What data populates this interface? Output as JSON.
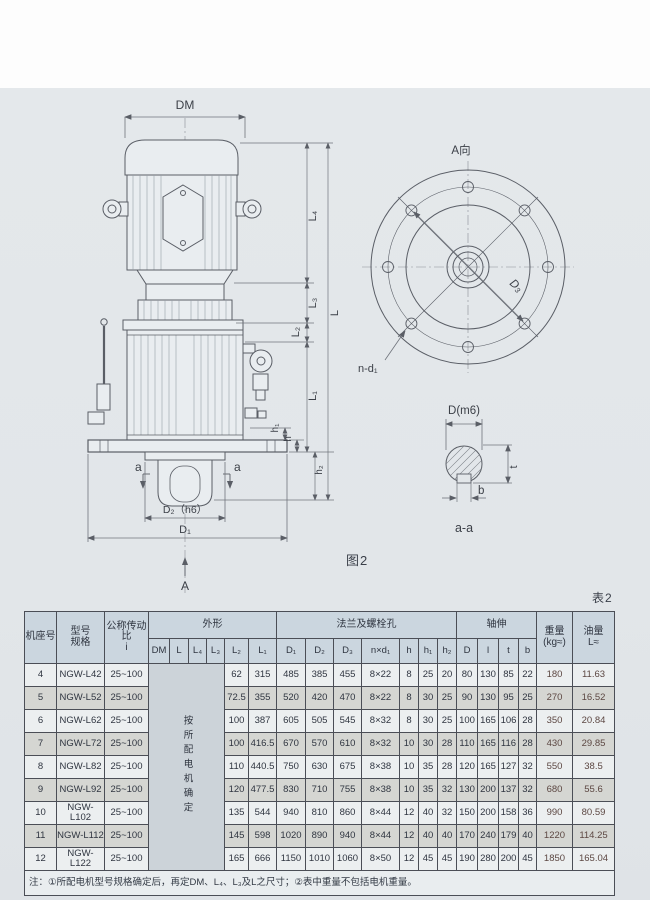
{
  "page": {
    "figure_caption": "图2",
    "table_caption": "表2"
  },
  "drawing": {
    "labels": {
      "dm": "DM",
      "l4": "L₄",
      "l3": "L₃",
      "l2": "L₂",
      "l1": "L₁",
      "l": "L",
      "h1": "h₁",
      "h": "h",
      "h2": "h₂",
      "d2h6": "D₂（h6）",
      "d1": "D₁",
      "a_bottom": "A",
      "a_left": "a",
      "a_right": "a",
      "flange_view": "A向",
      "d3": "D₃",
      "nd1": "n-d₁",
      "shaft_d": "D(m6)",
      "t": "t",
      "b": "b",
      "section": "a-a"
    }
  },
  "table": {
    "headers": {
      "frame": "机座号",
      "model": "型号\n规格",
      "ratio": "公称传动比\ni",
      "outline": "外形",
      "outline_cols": [
        "DM",
        "L",
        "L₄",
        "L₃",
        "L₂",
        "L₁"
      ],
      "flange": "法兰及螺栓孔",
      "flange_cols": [
        "D₁",
        "D₂",
        "D₃",
        "n×d₁",
        "h",
        "h₁",
        "h₂"
      ],
      "shaft": "轴伸",
      "shaft_cols": [
        "D",
        "l",
        "t",
        "b"
      ],
      "weight": "重量\n(kg≈)",
      "oil": "油量\nL≈"
    },
    "merged_note": "按所配电机确定",
    "rows": [
      {
        "frame": "4",
        "model": "NGW-L42",
        "ratio": "25~100",
        "l2": "62",
        "l1": "315",
        "d1": "485",
        "d2": "385",
        "d3": "455",
        "nd1": "8×22",
        "h": "8",
        "h1": "25",
        "h2": "20",
        "d": "80",
        "l": "130",
        "t": "85",
        "b": "22",
        "weight": "180",
        "oil": "11.63"
      },
      {
        "frame": "5",
        "model": "NGW-L52",
        "ratio": "25~100",
        "l2": "72.5",
        "l1": "355",
        "d1": "520",
        "d2": "420",
        "d3": "470",
        "nd1": "8×22",
        "h": "8",
        "h1": "30",
        "h2": "25",
        "d": "90",
        "l": "130",
        "t": "95",
        "b": "25",
        "weight": "270",
        "oil": "16.52"
      },
      {
        "frame": "6",
        "model": "NGW-L62",
        "ratio": "25~100",
        "l2": "100",
        "l1": "387",
        "d1": "605",
        "d2": "505",
        "d3": "545",
        "nd1": "8×32",
        "h": "8",
        "h1": "30",
        "h2": "25",
        "d": "100",
        "l": "165",
        "t": "106",
        "b": "28",
        "weight": "350",
        "oil": "20.84"
      },
      {
        "frame": "7",
        "model": "NGW-L72",
        "ratio": "25~100",
        "l2": "100",
        "l1": "416.5",
        "d1": "670",
        "d2": "570",
        "d3": "610",
        "nd1": "8×32",
        "h": "10",
        "h1": "30",
        "h2": "28",
        "d": "110",
        "l": "165",
        "t": "116",
        "b": "28",
        "weight": "430",
        "oil": "29.85"
      },
      {
        "frame": "8",
        "model": "NGW-L82",
        "ratio": "25~100",
        "l2": "110",
        "l1": "440.5",
        "d1": "750",
        "d2": "630",
        "d3": "675",
        "nd1": "8×38",
        "h": "10",
        "h1": "35",
        "h2": "28",
        "d": "120",
        "l": "165",
        "t": "127",
        "b": "32",
        "weight": "550",
        "oil": "38.5"
      },
      {
        "frame": "9",
        "model": "NGW-L92",
        "ratio": "25~100",
        "l2": "120",
        "l1": "477.5",
        "d1": "830",
        "d2": "710",
        "d3": "755",
        "nd1": "8×38",
        "h": "10",
        "h1": "35",
        "h2": "32",
        "d": "130",
        "l": "200",
        "t": "137",
        "b": "32",
        "weight": "680",
        "oil": "55.6"
      },
      {
        "frame": "10",
        "model": "NGW-L102",
        "ratio": "25~100",
        "l2": "135",
        "l1": "544",
        "d1": "940",
        "d2": "810",
        "d3": "860",
        "nd1": "8×44",
        "h": "12",
        "h1": "40",
        "h2": "32",
        "d": "150",
        "l": "200",
        "t": "158",
        "b": "36",
        "weight": "990",
        "oil": "80.59"
      },
      {
        "frame": "11",
        "model": "NGW-L112",
        "ratio": "25~100",
        "l2": "145",
        "l1": "598",
        "d1": "1020",
        "d2": "890",
        "d3": "940",
        "nd1": "8×44",
        "h": "12",
        "h1": "40",
        "h2": "40",
        "d": "170",
        "l": "240",
        "t": "179",
        "b": "40",
        "weight": "1220",
        "oil": "114.25"
      },
      {
        "frame": "12",
        "model": "NGW-L122",
        "ratio": "25~100",
        "l2": "165",
        "l1": "666",
        "d1": "1150",
        "d2": "1010",
        "d3": "1060",
        "nd1": "8×50",
        "h": "12",
        "h1": "45",
        "h2": "45",
        "d": "190",
        "l": "280",
        "t": "200",
        "b": "45",
        "weight": "1850",
        "oil": "165.04"
      }
    ],
    "footnote": "注：①所配电机型号规格确定后，再定DM、L₄、L₃及L之尺寸；②表中重量不包括电机重量。"
  }
}
